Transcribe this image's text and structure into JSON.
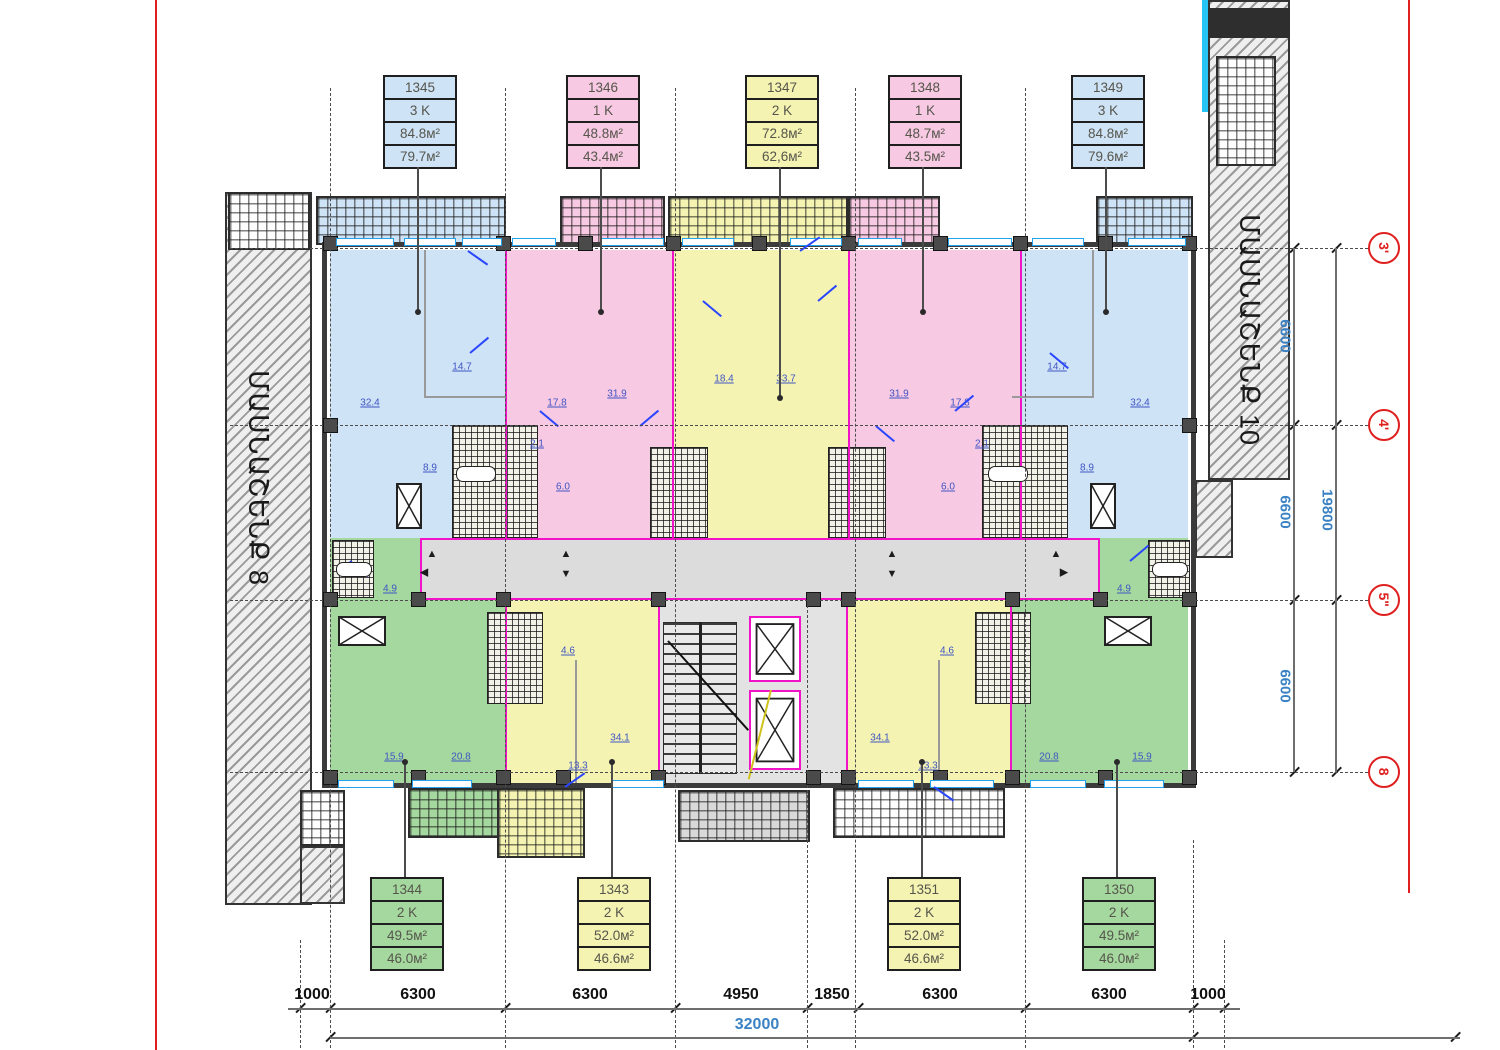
{
  "buildings": {
    "left": "ՄԱՍՆԱՇԵՆՔ 8",
    "right": "ՄԱՍՆԱՇԵՆՔ 10"
  },
  "apartments": {
    "top": [
      {
        "id": "1345",
        "rooms": "3 K",
        "area_total": "84.8м²",
        "area_living": "79.7м²",
        "color": "blue"
      },
      {
        "id": "1346",
        "rooms": "1 K",
        "area_total": "48.8м²",
        "area_living": "43.4м²",
        "color": "pink"
      },
      {
        "id": "1347",
        "rooms": "2 K",
        "area_total": "72.8м²",
        "area_living": "62,6м²",
        "color": "yellow"
      },
      {
        "id": "1348",
        "rooms": "1 K",
        "area_total": "48.7м²",
        "area_living": "43.5м²",
        "color": "pink"
      },
      {
        "id": "1349",
        "rooms": "3 K",
        "area_total": "84.8м²",
        "area_living": "79.6м²",
        "color": "blue"
      }
    ],
    "bottom": [
      {
        "id": "1344",
        "rooms": "2 K",
        "area_total": "49.5м²",
        "area_living": "46.0м²",
        "color": "green"
      },
      {
        "id": "1343",
        "rooms": "2 K",
        "area_total": "52.0м²",
        "area_living": "46.6м²",
        "color": "yellow"
      },
      {
        "id": "1351",
        "rooms": "2 K",
        "area_total": "52.0м²",
        "area_living": "46.6м²",
        "color": "yellow"
      },
      {
        "id": "1350",
        "rooms": "2 K",
        "area_total": "49.5м²",
        "area_living": "46.0м²",
        "color": "green"
      }
    ]
  },
  "dimensions": {
    "bottom": [
      "1000",
      "6300",
      "6300",
      "4950",
      "1850",
      "6300",
      "6300",
      "1000"
    ],
    "bottom_total": "32000",
    "right": [
      "6600",
      "6600",
      "6600"
    ],
    "right_total": "19800"
  },
  "axes": [
    "3'",
    "4'",
    "5\"",
    "8"
  ],
  "room_areas": [
    "32.4",
    "14.7",
    "8.9",
    "2.1",
    "6.0",
    "17.8",
    "31.9",
    "18.4",
    "33.7",
    "31.9",
    "17.8",
    "2.1",
    "6.0",
    "14.7",
    "32.4",
    "8.9",
    "4.9",
    "4.9",
    "15.9",
    "20.8",
    "13.3",
    "4.6",
    "34.1",
    "34.1",
    "4.6",
    "13.3",
    "20.8",
    "15.9"
  ],
  "icons": {
    "triangle_up": "▲",
    "triangle_down": "▼",
    "triangle_left": "◀",
    "triangle_right": "▶"
  },
  "colors": {
    "apartment_blue": "#cfe3f6",
    "apartment_pink": "#f8c9e2",
    "apartment_yellow": "#f5f3b2",
    "apartment_green": "#a5d89e",
    "corridor_gray": "#dcdcdc",
    "wall_dark": "#3b3b3b",
    "partition_magenta": "#f013c8",
    "window_cyan": "#23a3ec",
    "axis_red": "#e02020",
    "dimension_blue": "#3a82c4"
  }
}
